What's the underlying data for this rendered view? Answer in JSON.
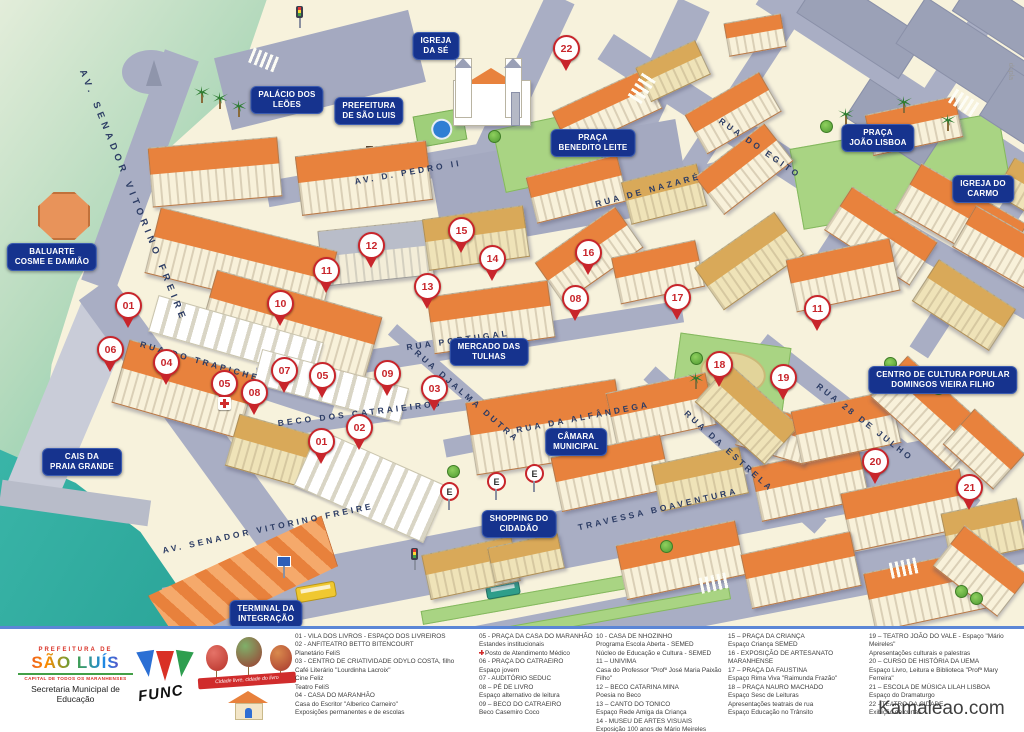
{
  "watermark": "Kamaleao.com",
  "side_note": "dupla",
  "colors": {
    "ground": "#f7f2dc",
    "street": "#a9aec4",
    "water_top": "#79c7a6",
    "water_bottom": "#2fb3a9",
    "label_bg": "#16338e",
    "marker_red": "#c8252b",
    "roof_orange": "#e8823d",
    "plaza_green": "#a9d483"
  },
  "map": {
    "place_labels": [
      {
        "id": "igreja-da-se",
        "lines": [
          "IGREJA",
          "DA SÉ"
        ],
        "x": 436,
        "y": 46
      },
      {
        "id": "palacio-dos-leoes",
        "lines": [
          "PALÁCIO DOS",
          "LEÕES"
        ],
        "x": 287,
        "y": 100
      },
      {
        "id": "prefeitura-de-sao-luis",
        "lines": [
          "PREFEITURA",
          "DE SÃO LUIS"
        ],
        "x": 369,
        "y": 111
      },
      {
        "id": "praca-benedito-leite",
        "lines": [
          "PRAÇA",
          "BENEDITO LEITE"
        ],
        "x": 593,
        "y": 143
      },
      {
        "id": "praca-joao-lisboa",
        "lines": [
          "PRAÇA",
          "JOÃO LISBOA"
        ],
        "x": 878,
        "y": 138
      },
      {
        "id": "igreja-do-carmo",
        "lines": [
          "IGREJA DO",
          "CARMO"
        ],
        "x": 983,
        "y": 189
      },
      {
        "id": "baluarte-cosme-e-damiao",
        "lines": [
          "BALUARTE",
          "COSME E DAMIÃO"
        ],
        "x": 52,
        "y": 257
      },
      {
        "id": "cais-da-praia-grande",
        "lines": [
          "CAIS DA",
          "PRAIA GRANDE"
        ],
        "x": 82,
        "y": 462
      },
      {
        "id": "mercado-das-tulhas",
        "lines": [
          "MERCADO DAS",
          "TULHAS"
        ],
        "x": 489,
        "y": 352
      },
      {
        "id": "camara-municipal",
        "lines": [
          "CÂMARA",
          "MUNICIPAL"
        ],
        "x": 576,
        "y": 442
      },
      {
        "id": "shopping-do-cidadao",
        "lines": [
          "SHOPPING DO",
          "CIDADÃO"
        ],
        "x": 519,
        "y": 524
      },
      {
        "id": "terminal-da-integracao",
        "lines": [
          "TERMINAL DA",
          "INTEGRAÇÃO"
        ],
        "x": 266,
        "y": 614
      },
      {
        "id": "centro-cultura-popular",
        "lines": [
          "CENTRO DE CULTURA POPULAR",
          "DOMINGOS VIEIRA FILHO"
        ],
        "x": 943,
        "y": 380
      }
    ],
    "street_labels": [
      {
        "text": "AV. SENADOR VITORINO FREIRE",
        "x": 133,
        "y": 196,
        "rot": 68,
        "big": true
      },
      {
        "text": "AV. SENADOR VITORINO FREIRE",
        "x": 268,
        "y": 528,
        "rot": -12
      },
      {
        "text": "AV. D. PEDRO II",
        "x": 408,
        "y": 172,
        "rot": -10
      },
      {
        "text": "RUA DE NAZARÉ",
        "x": 648,
        "y": 190,
        "rot": -15
      },
      {
        "text": "RUA DO EGITO",
        "x": 760,
        "y": 148,
        "rot": 35
      },
      {
        "text": "RUA PORTUGAL",
        "x": 458,
        "y": 340,
        "rot": -8
      },
      {
        "text": "RUA DO TRAPICHE",
        "x": 200,
        "y": 361,
        "rot": 16
      },
      {
        "text": "BECO DOS CATRAIEIROS",
        "x": 360,
        "y": 413,
        "rot": -7
      },
      {
        "text": "RUA DJALMA DUTRA",
        "x": 467,
        "y": 396,
        "rot": 41
      },
      {
        "text": "RUA DA ALFÂNDEGA",
        "x": 583,
        "y": 417,
        "rot": -11
      },
      {
        "text": "RUA DA ESTRELA",
        "x": 729,
        "y": 451,
        "rot": 42
      },
      {
        "text": "RUA 28 DE JULHO",
        "x": 865,
        "y": 422,
        "rot": 38
      },
      {
        "text": "TRAVESSA BOAVENTURA",
        "x": 658,
        "y": 509,
        "rot": -13
      }
    ],
    "markers": [
      {
        "n": "22",
        "x": 566,
        "y": 48
      },
      {
        "n": "15",
        "x": 461,
        "y": 230
      },
      {
        "n": "12",
        "x": 371,
        "y": 245
      },
      {
        "n": "16",
        "x": 588,
        "y": 252
      },
      {
        "n": "14",
        "x": 492,
        "y": 258
      },
      {
        "n": "11",
        "x": 326,
        "y": 270
      },
      {
        "n": "13",
        "x": 427,
        "y": 286
      },
      {
        "n": "17",
        "x": 677,
        "y": 297
      },
      {
        "n": "08",
        "x": 575,
        "y": 298
      },
      {
        "n": "10",
        "x": 280,
        "y": 303
      },
      {
        "n": "01",
        "x": 128,
        "y": 305
      },
      {
        "n": "11",
        "x": 817,
        "y": 308
      },
      {
        "n": "06",
        "x": 110,
        "y": 349
      },
      {
        "n": "04",
        "x": 166,
        "y": 362
      },
      {
        "n": "18",
        "x": 719,
        "y": 364
      },
      {
        "n": "07",
        "x": 284,
        "y": 370
      },
      {
        "n": "09",
        "x": 387,
        "y": 373
      },
      {
        "n": "05",
        "x": 322,
        "y": 375
      },
      {
        "n": "19",
        "x": 783,
        "y": 377
      },
      {
        "n": "05",
        "x": 224,
        "y": 383,
        "cross": true
      },
      {
        "n": "03",
        "x": 434,
        "y": 388
      },
      {
        "n": "08",
        "x": 254,
        "y": 392
      },
      {
        "n": "02",
        "x": 359,
        "y": 427
      },
      {
        "n": "01",
        "x": 321,
        "y": 441
      },
      {
        "n": "20",
        "x": 875,
        "y": 461
      },
      {
        "n": "21",
        "x": 969,
        "y": 487
      }
    ],
    "parking_signs": [
      {
        "label": "E",
        "x": 448,
        "y": 490
      },
      {
        "label": "E",
        "x": 495,
        "y": 480
      },
      {
        "label": "E",
        "x": 533,
        "y": 472
      }
    ]
  },
  "legend": {
    "columns": [
      {
        "items": [
          {
            "t": "01 - VILA DOS LIVROS - ESPAÇO DOS LIVREIROS"
          },
          {
            "t": "02 - ANFITEATRO BETTO BITENCOURT"
          },
          {
            "t": "Planetário FeliS"
          },
          {
            "t": "03 - CENTRO DE CRIATIVIDADE ODYLO COSTA, filho"
          },
          {
            "t": "Café Literário \"Lourdinha Lacroix\""
          },
          {
            "t": "Cine Feliz"
          },
          {
            "t": "Teatro FeliS"
          },
          {
            "t": "04 - CASA DO MARANHÃO"
          },
          {
            "t": "Casa do Escritor \"Alberico Carneiro\""
          },
          {
            "t": "Exposições permanentes e de escolas"
          }
        ]
      },
      {
        "items": [
          {
            "t": "05 - PRAÇA DA CASA DO MARANHÃO"
          },
          {
            "t": "Estandes institucionais"
          },
          {
            "t": "Posto de Atendimento Médico",
            "icon": "red-cross"
          },
          {
            "t": "06 - PRAÇA DO CATRAEIRO"
          },
          {
            "t": "Espaço jovem"
          },
          {
            "t": "07 - AUDITÓRIO SEDUC"
          },
          {
            "t": "08 – PÉ DE LIVRO"
          },
          {
            "t": "Espaço alternativo de leitura"
          },
          {
            "t": "09 – BECO DO CATRAEIRO"
          },
          {
            "t": "Beco Casemiro Coco"
          }
        ]
      },
      {
        "items": [
          {
            "t": "10 - CASA DE NHOZINHO"
          },
          {
            "t": "Programa Escola Aberta - SEMED"
          },
          {
            "t": "Núcleo de Educação e Cultura - SEMED"
          },
          {
            "t": "11 – UNIVIMA"
          },
          {
            "t": "Casa do Professor \"Profº José Maria Paixão Filho\""
          },
          {
            "t": "12 – BECO CATARINA MINA"
          },
          {
            "t": "Poesia no Beco"
          },
          {
            "t": "13 – CANTO DO TONICO"
          },
          {
            "t": "Espaço Rede Amiga da Criança"
          },
          {
            "t": "14 - MUSEU DE ARTES VISUAIS"
          },
          {
            "t": "Exposição 100 anos de Mário Meireles"
          }
        ]
      },
      {
        "items": [
          {
            "t": "15 – PRAÇA DA CRIANÇA"
          },
          {
            "t": "Espaço Criança SEMED"
          },
          {
            "t": "16 - EXPOSIÇÃO  DE ARTESANATO MARANHENSE"
          },
          {
            "t": "17 – PRAÇA DA FAUSTINA"
          },
          {
            "t": "Espaço Rima Viva \"Raimunda Frazão\""
          },
          {
            "t": "18 – PRAÇA NAURO MACHADO"
          },
          {
            "t": "Espaço Sesc de Leituras"
          },
          {
            "t": "Apresentações teatrais de rua"
          },
          {
            "t": "Espaço Educação no Trânsito"
          }
        ]
      },
      {
        "items": [
          {
            "t": "19 – TEATRO JOÃO DO VALE - Espaço \"Mário Meireles\""
          },
          {
            "t": "Apresentações culturais e palestras"
          },
          {
            "t": "20 – CURSO DE HISTÓRIA DA UEMA"
          },
          {
            "t": "Espaço Livro, Leitura e Biblioteca \"Profª Mary Ferreira\""
          },
          {
            "t": "21 – ESCOLA DE MÚSICA LILAH LISBOA"
          },
          {
            "t": "Espaço do Dramaturgo"
          },
          {
            "t": "22 - TEATRO DA CIDADE"
          },
          {
            "t": "Exibição de curtas"
          }
        ]
      }
    ]
  },
  "footer": {
    "prefeitura": {
      "line1": "PREFEITURA DE",
      "name": "SÃO LUÍS",
      "tagline": "CAPITAL DE TODOS OS MARANHENSES",
      "dept": "Secretaria Municipal de Educação"
    },
    "func": {
      "name": "FUNC"
    },
    "balloons": {
      "ribbon": "Cidade livre, cidade do livro"
    }
  }
}
